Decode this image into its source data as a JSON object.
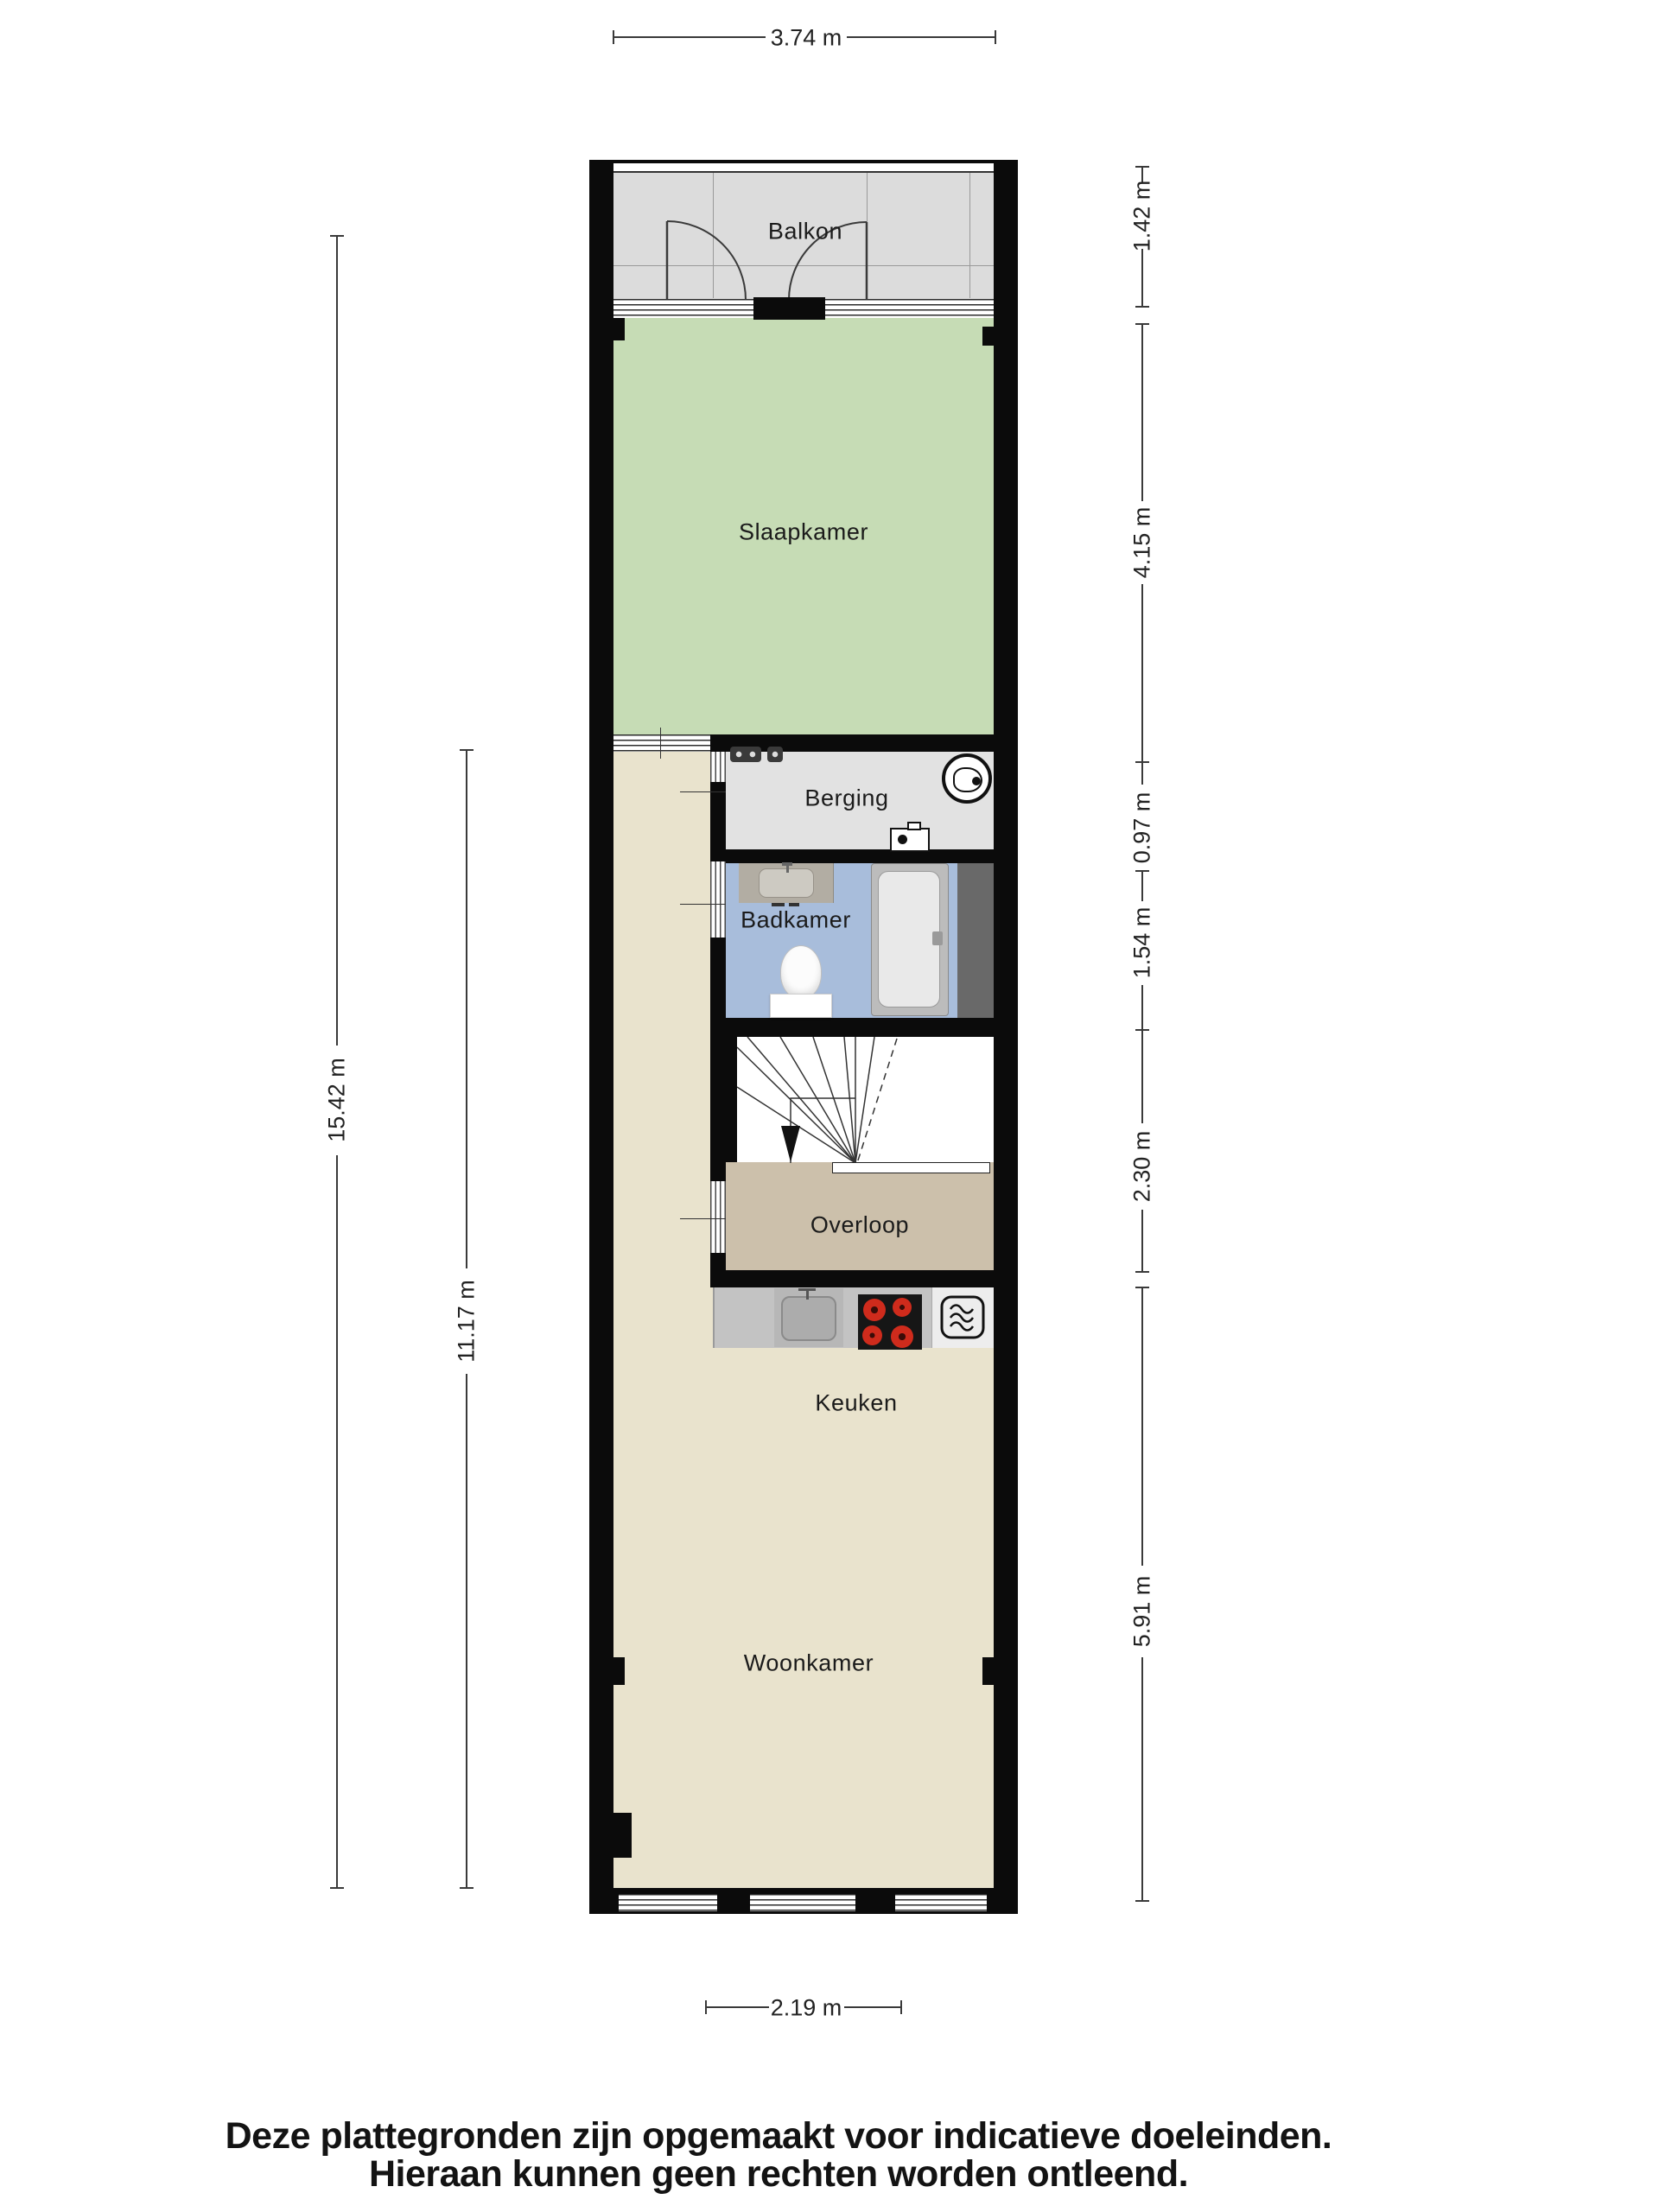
{
  "plan": {
    "type": "floor-plan",
    "rooms": {
      "balkon": {
        "label": "Balkon",
        "floor_color": "#dcdcdc"
      },
      "slaapkamer": {
        "label": "Slaapkamer",
        "floor_color": "#c6dcb5"
      },
      "berging": {
        "label": "Berging",
        "floor_color": "#e2e2e2"
      },
      "badkamer": {
        "label": "Badkamer",
        "floor_color": "#a8bddb"
      },
      "overloop": {
        "label": "Overloop",
        "floor_color": "#ccc0ab"
      },
      "keuken": {
        "label": "Keuken",
        "floor_color": "#e9e3cd"
      },
      "woonkamer": {
        "label": "Woonkamer",
        "floor_color": "#e9e3cd"
      }
    },
    "colors": {
      "wall": "#0b0b0b",
      "hallway_floor": "#e9e3cd",
      "stairs_floor": "#ffffff",
      "counter_gray": "#c3c3c3",
      "stove_black": "#161616",
      "burner_red": "#cf2b1c",
      "tub_gray": "#bcbcbc",
      "side_panel_dark": "#696969"
    },
    "icons": {
      "washing_machine": "circle-with-drum-glyph",
      "boiler": "white-box-with-black-dot",
      "utility_meters": "two-small-dark-meter-glyphs",
      "bathroom_sink": "counter-with-basin-and-faucet",
      "toilet": "bowl-with-cistern",
      "bathtub": "rounded-tub-with-faucet",
      "kitchen_sink": "square-basin-with-faucet",
      "stove": "four-burner-hob",
      "microwave": "rounded-square-with-heat-waves",
      "stairs_direction": "down-arrow"
    }
  },
  "dimensions": {
    "top_width": "3.74 m",
    "left_total_height": "15.42 m",
    "left_lower_height": "11.17 m",
    "right": {
      "balkon": "1.42 m",
      "slaapkamer": "4.15 m",
      "berging": "0.97 m",
      "badkamer": "1.54 m",
      "trap_overloop": "2.30 m",
      "keuken_woonkamer": "5.91 m"
    },
    "bottom_width": "2.19 m"
  },
  "disclaimer": {
    "line1": "Deze plattegronden zijn opgemaakt voor indicatieve doeleinden.",
    "line2": "Hieraan kunnen geen rechten worden ontleend."
  }
}
